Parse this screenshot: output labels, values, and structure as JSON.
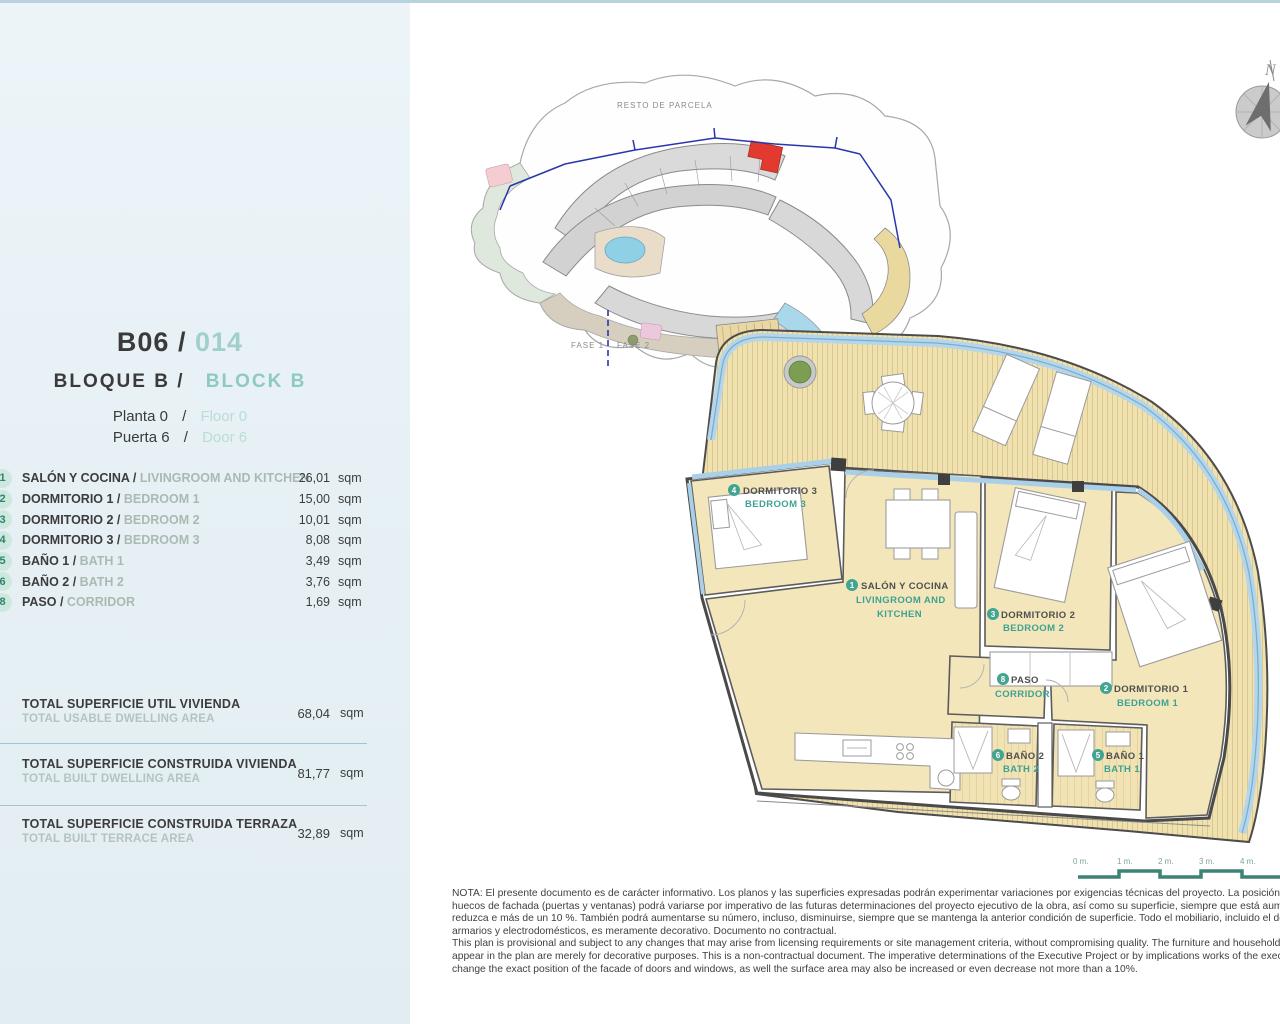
{
  "colors": {
    "accent_teal": "#3da294",
    "sidebar_badge": "#cfe8de",
    "sidebar_bg": "#e9f2f6",
    "top_strip_blue": "#b7d3e0",
    "highlight_red": "#e23a2e",
    "deck_tan": "#f0e2b0",
    "room_tan": "#f3e6ba",
    "balustrade_blue": "#b5d6ea"
  },
  "header": {
    "unit_code": "B06",
    "sep": "/",
    "unit_number": "014",
    "bloque_es": "BLOQUE B",
    "bloque_en": "BLOCK B",
    "planta_es": "Planta 0",
    "planta_en": "Floor 0",
    "puerta_es": "Puerta 6",
    "puerta_en": "Door 6"
  },
  "rooms": [
    {
      "num": "1",
      "es": "SALÓN Y COCINA / ",
      "en": "LIVINGROOM AND KITCHEN",
      "area": "26,01",
      "unit": "sqm"
    },
    {
      "num": "2",
      "es": "DORMITORIO 1 / ",
      "en": "BEDROOM 1",
      "area": "15,00",
      "unit": "sqm"
    },
    {
      "num": "3",
      "es": "DORMITORIO 2 / ",
      "en": "BEDROOM 2",
      "area": "10,01",
      "unit": "sqm"
    },
    {
      "num": "4",
      "es": "DORMITORIO 3 / ",
      "en": "BEDROOM 3",
      "area": "8,08",
      "unit": "sqm"
    },
    {
      "num": "5",
      "es": "BAÑO 1 / ",
      "en": "BATH 1",
      "area": "3,49",
      "unit": "sqm"
    },
    {
      "num": "6",
      "es": "BAÑO 2 / ",
      "en": "BATH 2",
      "area": "3,76",
      "unit": "sqm"
    },
    {
      "num": "8",
      "es": "PASO / ",
      "en": "CORRIDOR",
      "area": "1,69",
      "unit": "sqm"
    }
  ],
  "totals": [
    {
      "es": "TOTAL SUPERFICIE UTIL VIVIENDA",
      "en": "TOTAL USABLE DWELLING AREA",
      "value": "68,04",
      "unit": "sqm"
    },
    {
      "es": "TOTAL SUPERFICIE CONSTRUIDA VIVIENDA",
      "en": "TOTAL BUILT DWELLING AREA",
      "value": "81,77",
      "unit": "sqm"
    },
    {
      "es": "TOTAL SUPERFICIE CONSTRUIDA TERRAZA",
      "en": "TOTAL BUILT TERRACE AREA",
      "value": "32,89",
      "unit": "sqm"
    }
  ],
  "site_plan": {
    "resto_label": "RESTO DE PARCELA",
    "fase1": "FASE 1",
    "fase2": "FASE 2"
  },
  "compass": {
    "north_label": "N"
  },
  "floor_plan": {
    "salon": {
      "num": "1",
      "es": "SALÓN Y COCINA",
      "en1": "LIVINGROOM AND",
      "en2": "KITCHEN"
    },
    "dorm1": {
      "num": "2",
      "es": "DORMITORIO 1",
      "en": "BEDROOM 1"
    },
    "dorm2": {
      "num": "3",
      "es": "DORMITORIO 2",
      "en": "BEDROOM 2"
    },
    "dorm3": {
      "num": "4",
      "es": "DORMITORIO 3",
      "en": "BEDROOM 3"
    },
    "bath1": {
      "num": "5",
      "es": "BAÑO 1",
      "en": "BATH 1"
    },
    "bath2": {
      "num": "6",
      "es": "BAÑO 2",
      "en": "BATH 2"
    },
    "paso": {
      "num": "8",
      "es": "PASO",
      "en": "CORRIDOR"
    }
  },
  "scale_bar": {
    "ticks": [
      "0 m.",
      "1 m.",
      "2 m.",
      "3 m.",
      "4 m."
    ]
  },
  "notes": {
    "es_lines": [
      "NOTA: El presente documento es de carácter informativo. Los planos y las superficies expresadas podrán experimentar variaciones por exigencias técnicas del proyecto. La posición exacta de los",
      "huecos de fachada (puertas y ventanas) podrá variarse por imperativo de las futuras determinaciones del proyecto ejecutivo de la obra, así como su superficie, siempre que está aumente o no se",
      "reduzca e más de un 10 %. También podrá aumentarse su número, incluso, disminuirse, siempre que se mantenga la anterior condición de superficie. Todo el mobiliario, incluido el de la cocina,",
      "armarios y electrodomésticos, es meramente decorativo. Documento no contractual."
    ],
    "en_lines": [
      "This plan is provisional and subject to any changes that may arise from licensing requirements or site management criteria, without compromising quality. The furniture and household items that",
      "appear in the plan are merely for decorative purposes. This is a non-contractual document. The imperative determinations of the Executive Project or by implications works of the execution, can",
      "change the exact position of the facade of doors and windows, as well the surface area may also be increased or even decrease not more than a 10%."
    ]
  }
}
